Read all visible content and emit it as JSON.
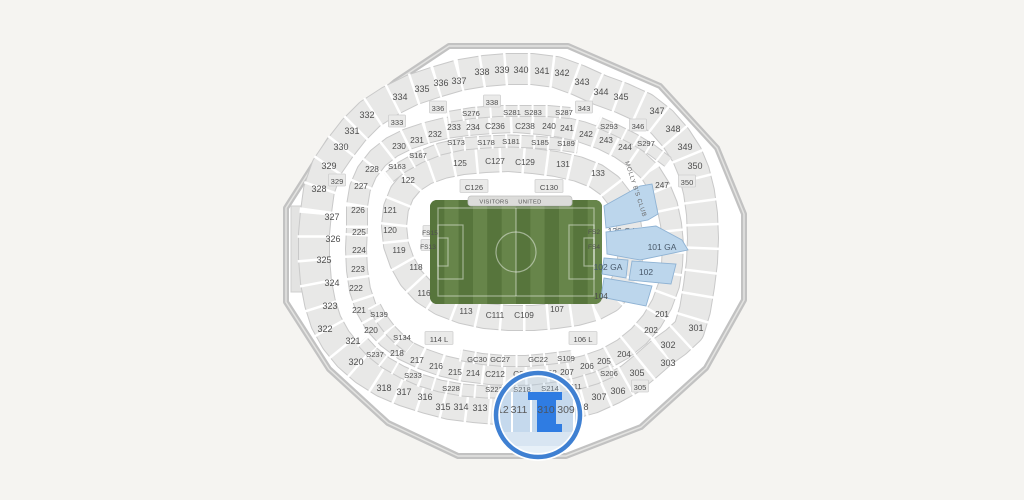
{
  "map": {
    "venue_type": "stadium-seating-chart",
    "field": {
      "sport": "soccer",
      "visitors_label": "VISITORS",
      "united_label": "UNITED"
    },
    "club": {
      "text": "MOLLY B'S CLUB",
      "x": 625,
      "y": 182,
      "rotation": 72
    },
    "colors": {
      "background": "#f5f4f1",
      "section_fill": "#e8e8e7",
      "section_border": "#c9c9c9",
      "wall": "#c2c2c2",
      "interior": "#ffffff",
      "label": "#4e4e4e",
      "field_green_dark": "#57753c",
      "field_green_light": "#67854a",
      "pitch_line": "rgba(255,255,255,0.45)",
      "ga_fill": "#bcd6ec",
      "ga_border": "#8fb3d4",
      "ga_label": "#49596a",
      "selected_fill": "#2f7ce2",
      "selected_label": "#4a5563",
      "magnifier_ring": "#3f80d2",
      "magnifier_tint": "rgba(170,200,230,0.28)",
      "magnifier_area": "#c5d9ed",
      "magnifier_strip": "#d8e5f2"
    },
    "magnifier": {
      "cx": 538,
      "cy": 415,
      "r": 42,
      "selected_section": "310",
      "labels": [
        {
          "t": "312",
          "x": 500
        },
        {
          "t": "311",
          "x": 519
        },
        {
          "t": "310",
          "x": 546
        },
        {
          "t": "309",
          "x": 566
        }
      ],
      "label_y": 409
    },
    "ga_sections": [
      {
        "label": "136 GA",
        "lx": 622,
        "ly": 231,
        "pts": "604,206 640,186 652,184 658,214 648,220 606,228"
      },
      {
        "label": "101 GA",
        "lx": 662,
        "ly": 247,
        "pts": "606,232 656,226 682,240 688,250 640,260 607,254"
      },
      {
        "label": "102 GA",
        "lx": 608,
        "ly": 267,
        "pts": "604,258 628,260 626,278 602,274"
      },
      {
        "label": "102",
        "lx": 646,
        "ly": 272,
        "pts": "632,261 676,264 671,284 629,280"
      },
      {
        "label": "",
        "lx": 0,
        "ly": 0,
        "pts": "604,278 652,286 646,306 601,297"
      }
    ],
    "sections": [
      {
        "label": "328",
        "x": 319,
        "y": 189,
        "ring": "o"
      },
      {
        "label": "329",
        "x": 329,
        "y": 166,
        "ring": "o"
      },
      {
        "label": "329",
        "x": 337,
        "y": 181,
        "ring": "xs"
      },
      {
        "label": "330",
        "x": 341,
        "y": 147,
        "ring": "o"
      },
      {
        "label": "331",
        "x": 352,
        "y": 131,
        "ring": "o"
      },
      {
        "label": "332",
        "x": 367,
        "y": 115,
        "ring": "o"
      },
      {
        "label": "333",
        "x": 397,
        "y": 122,
        "ring": "xs"
      },
      {
        "label": "334",
        "x": 400,
        "y": 97,
        "ring": "o"
      },
      {
        "label": "335",
        "x": 422,
        "y": 89,
        "ring": "o"
      },
      {
        "label": "336",
        "x": 441,
        "y": 83,
        "ring": "o"
      },
      {
        "label": "336",
        "x": 438,
        "y": 108,
        "ring": "xs"
      },
      {
        "label": "337",
        "x": 459,
        "y": 81,
        "ring": "o"
      },
      {
        "label": "338",
        "x": 482,
        "y": 72,
        "ring": "o"
      },
      {
        "label": "338",
        "x": 492,
        "y": 102,
        "ring": "xs"
      },
      {
        "label": "339",
        "x": 502,
        "y": 70,
        "ring": "o"
      },
      {
        "label": "340",
        "x": 521,
        "y": 70,
        "ring": "o"
      },
      {
        "label": "341",
        "x": 542,
        "y": 71,
        "ring": "o"
      },
      {
        "label": "342",
        "x": 562,
        "y": 73,
        "ring": "o"
      },
      {
        "label": "343",
        "x": 582,
        "y": 82,
        "ring": "o"
      },
      {
        "label": "343",
        "x": 584,
        "y": 108,
        "ring": "xs"
      },
      {
        "label": "344",
        "x": 601,
        "y": 92,
        "ring": "o"
      },
      {
        "label": "345",
        "x": 621,
        "y": 97,
        "ring": "o"
      },
      {
        "label": "346",
        "x": 638,
        "y": 126,
        "ring": "xs"
      },
      {
        "label": "347",
        "x": 657,
        "y": 111,
        "ring": "o"
      },
      {
        "label": "348",
        "x": 673,
        "y": 129,
        "ring": "o"
      },
      {
        "label": "349",
        "x": 685,
        "y": 147,
        "ring": "o"
      },
      {
        "label": "350",
        "x": 695,
        "y": 166,
        "ring": "o"
      },
      {
        "label": "350",
        "x": 687,
        "y": 182,
        "ring": "xs"
      },
      {
        "label": "301",
        "x": 696,
        "y": 328,
        "ring": "o"
      },
      {
        "label": "302",
        "x": 668,
        "y": 345,
        "ring": "o"
      },
      {
        "label": "303",
        "x": 668,
        "y": 363,
        "ring": "o"
      },
      {
        "label": "305",
        "x": 637,
        "y": 373,
        "ring": "o"
      },
      {
        "label": "305",
        "x": 640,
        "y": 387,
        "ring": "xs"
      },
      {
        "label": "306",
        "x": 618,
        "y": 391,
        "ring": "o"
      },
      {
        "label": "307",
        "x": 599,
        "y": 397,
        "ring": "o"
      },
      {
        "label": "308",
        "x": 581,
        "y": 407,
        "ring": "o"
      },
      {
        "label": "313",
        "x": 480,
        "y": 408,
        "ring": "o"
      },
      {
        "label": "314",
        "x": 461,
        "y": 407,
        "ring": "o"
      },
      {
        "label": "315",
        "x": 443,
        "y": 407,
        "ring": "o"
      },
      {
        "label": "316",
        "x": 425,
        "y": 397,
        "ring": "o"
      },
      {
        "label": "317",
        "x": 404,
        "y": 392,
        "ring": "o"
      },
      {
        "label": "318",
        "x": 384,
        "y": 388,
        "ring": "o"
      },
      {
        "label": "320",
        "x": 356,
        "y": 362,
        "ring": "o"
      },
      {
        "label": "321",
        "x": 353,
        "y": 341,
        "ring": "o"
      },
      {
        "label": "322",
        "x": 325,
        "y": 329,
        "ring": "o"
      },
      {
        "label": "323",
        "x": 330,
        "y": 306,
        "ring": "o"
      },
      {
        "label": "324",
        "x": 332,
        "y": 283,
        "ring": "o"
      },
      {
        "label": "325",
        "x": 324,
        "y": 260,
        "ring": "o"
      },
      {
        "label": "326",
        "x": 333,
        "y": 239,
        "ring": "o"
      },
      {
        "label": "327",
        "x": 332,
        "y": 217,
        "ring": "o"
      },
      {
        "label": "227",
        "x": 361,
        "y": 186,
        "ring": "m"
      },
      {
        "label": "228",
        "x": 372,
        "y": 169,
        "ring": "m"
      },
      {
        "label": "230",
        "x": 399,
        "y": 146,
        "ring": "m"
      },
      {
        "label": "231",
        "x": 417,
        "y": 140,
        "ring": "m"
      },
      {
        "label": "232",
        "x": 435,
        "y": 134,
        "ring": "m"
      },
      {
        "label": "233",
        "x": 454,
        "y": 127,
        "ring": "m"
      },
      {
        "label": "234",
        "x": 473,
        "y": 127,
        "ring": "m"
      },
      {
        "label": "C236",
        "x": 495,
        "y": 126,
        "ring": "m"
      },
      {
        "label": "C238",
        "x": 525,
        "y": 126,
        "ring": "m"
      },
      {
        "label": "240",
        "x": 549,
        "y": 126,
        "ring": "m"
      },
      {
        "label": "241",
        "x": 567,
        "y": 128,
        "ring": "m"
      },
      {
        "label": "242",
        "x": 586,
        "y": 134,
        "ring": "m"
      },
      {
        "label": "243",
        "x": 606,
        "y": 140,
        "ring": "m"
      },
      {
        "label": "244",
        "x": 625,
        "y": 147,
        "ring": "m"
      },
      {
        "label": "247",
        "x": 662,
        "y": 185,
        "ring": "m"
      },
      {
        "label": "201",
        "x": 662,
        "y": 314,
        "ring": "m"
      },
      {
        "label": "202",
        "x": 651,
        "y": 330,
        "ring": "m"
      },
      {
        "label": "204",
        "x": 624,
        "y": 354,
        "ring": "m"
      },
      {
        "label": "205",
        "x": 604,
        "y": 361,
        "ring": "m"
      },
      {
        "label": "206",
        "x": 587,
        "y": 366,
        "ring": "m"
      },
      {
        "label": "207",
        "x": 567,
        "y": 372,
        "ring": "m"
      },
      {
        "label": "208",
        "x": 550,
        "y": 373,
        "ring": "m"
      },
      {
        "label": "C210",
        "x": 523,
        "y": 374,
        "ring": "m"
      },
      {
        "label": "C212",
        "x": 495,
        "y": 374,
        "ring": "m"
      },
      {
        "label": "214",
        "x": 473,
        "y": 373,
        "ring": "m"
      },
      {
        "label": "215",
        "x": 455,
        "y": 372,
        "ring": "m"
      },
      {
        "label": "216",
        "x": 436,
        "y": 366,
        "ring": "m"
      },
      {
        "label": "217",
        "x": 417,
        "y": 360,
        "ring": "m"
      },
      {
        "label": "218",
        "x": 397,
        "y": 353,
        "ring": "m"
      },
      {
        "label": "220",
        "x": 371,
        "y": 330,
        "ring": "m"
      },
      {
        "label": "221",
        "x": 359,
        "y": 310,
        "ring": "m"
      },
      {
        "label": "222",
        "x": 356,
        "y": 288,
        "ring": "m"
      },
      {
        "label": "223",
        "x": 358,
        "y": 269,
        "ring": "m"
      },
      {
        "label": "224",
        "x": 359,
        "y": 250,
        "ring": "m"
      },
      {
        "label": "225",
        "x": 359,
        "y": 232,
        "ring": "m"
      },
      {
        "label": "226",
        "x": 358,
        "y": 210,
        "ring": "m"
      },
      {
        "label": "121",
        "x": 390,
        "y": 210,
        "ring": "i"
      },
      {
        "label": "120",
        "x": 390,
        "y": 230,
        "ring": "i"
      },
      {
        "label": "119",
        "x": 399,
        "y": 250,
        "ring": "i"
      },
      {
        "label": "118",
        "x": 416,
        "y": 267,
        "ring": "i"
      },
      {
        "label": "116",
        "x": 424,
        "y": 293,
        "ring": "i"
      },
      {
        "label": "113",
        "x": 466,
        "y": 311,
        "ring": "i"
      },
      {
        "label": "C111",
        "x": 495,
        "y": 315,
        "ring": "i"
      },
      {
        "label": "C109",
        "x": 524,
        "y": 315,
        "ring": "i"
      },
      {
        "label": "107",
        "x": 557,
        "y": 309,
        "ring": "i"
      },
      {
        "label": "104",
        "x": 601,
        "y": 296,
        "ring": "i"
      },
      {
        "label": "122",
        "x": 408,
        "y": 180,
        "ring": "i"
      },
      {
        "label": "125",
        "x": 460,
        "y": 163,
        "ring": "i"
      },
      {
        "label": "C127",
        "x": 495,
        "y": 161,
        "ring": "i"
      },
      {
        "label": "C129",
        "x": 525,
        "y": 162,
        "ring": "i"
      },
      {
        "label": "131",
        "x": 563,
        "y": 164,
        "ring": "i"
      },
      {
        "label": "133",
        "x": 598,
        "y": 173,
        "ring": "i"
      },
      {
        "label": "C126",
        "x": 474,
        "y": 187,
        "ring": "t"
      },
      {
        "label": "C130",
        "x": 549,
        "y": 187,
        "ring": "t"
      },
      {
        "label": "114 L",
        "x": 439,
        "y": 339,
        "ring": "t"
      },
      {
        "label": "106 L",
        "x": 583,
        "y": 339,
        "ring": "t"
      },
      {
        "label": "S163",
        "x": 397,
        "y": 166,
        "ring": "s"
      },
      {
        "label": "S167",
        "x": 418,
        "y": 155,
        "ring": "s"
      },
      {
        "label": "S173",
        "x": 456,
        "y": 142,
        "ring": "s"
      },
      {
        "label": "S178",
        "x": 486,
        "y": 142,
        "ring": "s"
      },
      {
        "label": "S181",
        "x": 511,
        "y": 141,
        "ring": "s"
      },
      {
        "label": "S185",
        "x": 540,
        "y": 142,
        "ring": "s"
      },
      {
        "label": "S189",
        "x": 566,
        "y": 143,
        "ring": "s"
      },
      {
        "label": "S276",
        "x": 471,
        "y": 113,
        "ring": "s"
      },
      {
        "label": "S281",
        "x": 512,
        "y": 112,
        "ring": "s"
      },
      {
        "label": "S283",
        "x": 533,
        "y": 112,
        "ring": "s"
      },
      {
        "label": "S287",
        "x": 564,
        "y": 112,
        "ring": "s"
      },
      {
        "label": "S293",
        "x": 609,
        "y": 126,
        "ring": "s"
      },
      {
        "label": "S297",
        "x": 646,
        "y": 143,
        "ring": "s"
      },
      {
        "label": "S139",
        "x": 379,
        "y": 314,
        "ring": "s"
      },
      {
        "label": "S134",
        "x": 402,
        "y": 337,
        "ring": "s"
      },
      {
        "label": "S237",
        "x": 375,
        "y": 354,
        "ring": "s"
      },
      {
        "label": "S233",
        "x": 413,
        "y": 375,
        "ring": "s"
      },
      {
        "label": "S228",
        "x": 451,
        "y": 388,
        "ring": "s"
      },
      {
        "label": "S222",
        "x": 494,
        "y": 389,
        "ring": "s"
      },
      {
        "label": "S218",
        "x": 522,
        "y": 389,
        "ring": "s"
      },
      {
        "label": "S214",
        "x": 550,
        "y": 388,
        "ring": "s"
      },
      {
        "label": "S211",
        "x": 573,
        "y": 386,
        "ring": "s"
      },
      {
        "label": "S206",
        "x": 609,
        "y": 373,
        "ring": "s"
      },
      {
        "label": "S109",
        "x": 566,
        "y": 358,
        "ring": "s"
      },
      {
        "label": "GC30",
        "x": 477,
        "y": 359,
        "ring": "s"
      },
      {
        "label": "GC27",
        "x": 500,
        "y": 359,
        "ring": "s"
      },
      {
        "label": "GC22",
        "x": 538,
        "y": 359,
        "ring": "s"
      },
      {
        "label": "FS15",
        "x": 430,
        "y": 232,
        "ring": "fs"
      },
      {
        "label": "FS13",
        "x": 428,
        "y": 246,
        "ring": "fs"
      },
      {
        "label": "FS2",
        "x": 594,
        "y": 231,
        "ring": "fs"
      },
      {
        "label": "FS4",
        "x": 594,
        "y": 246,
        "ring": "fs"
      }
    ]
  }
}
